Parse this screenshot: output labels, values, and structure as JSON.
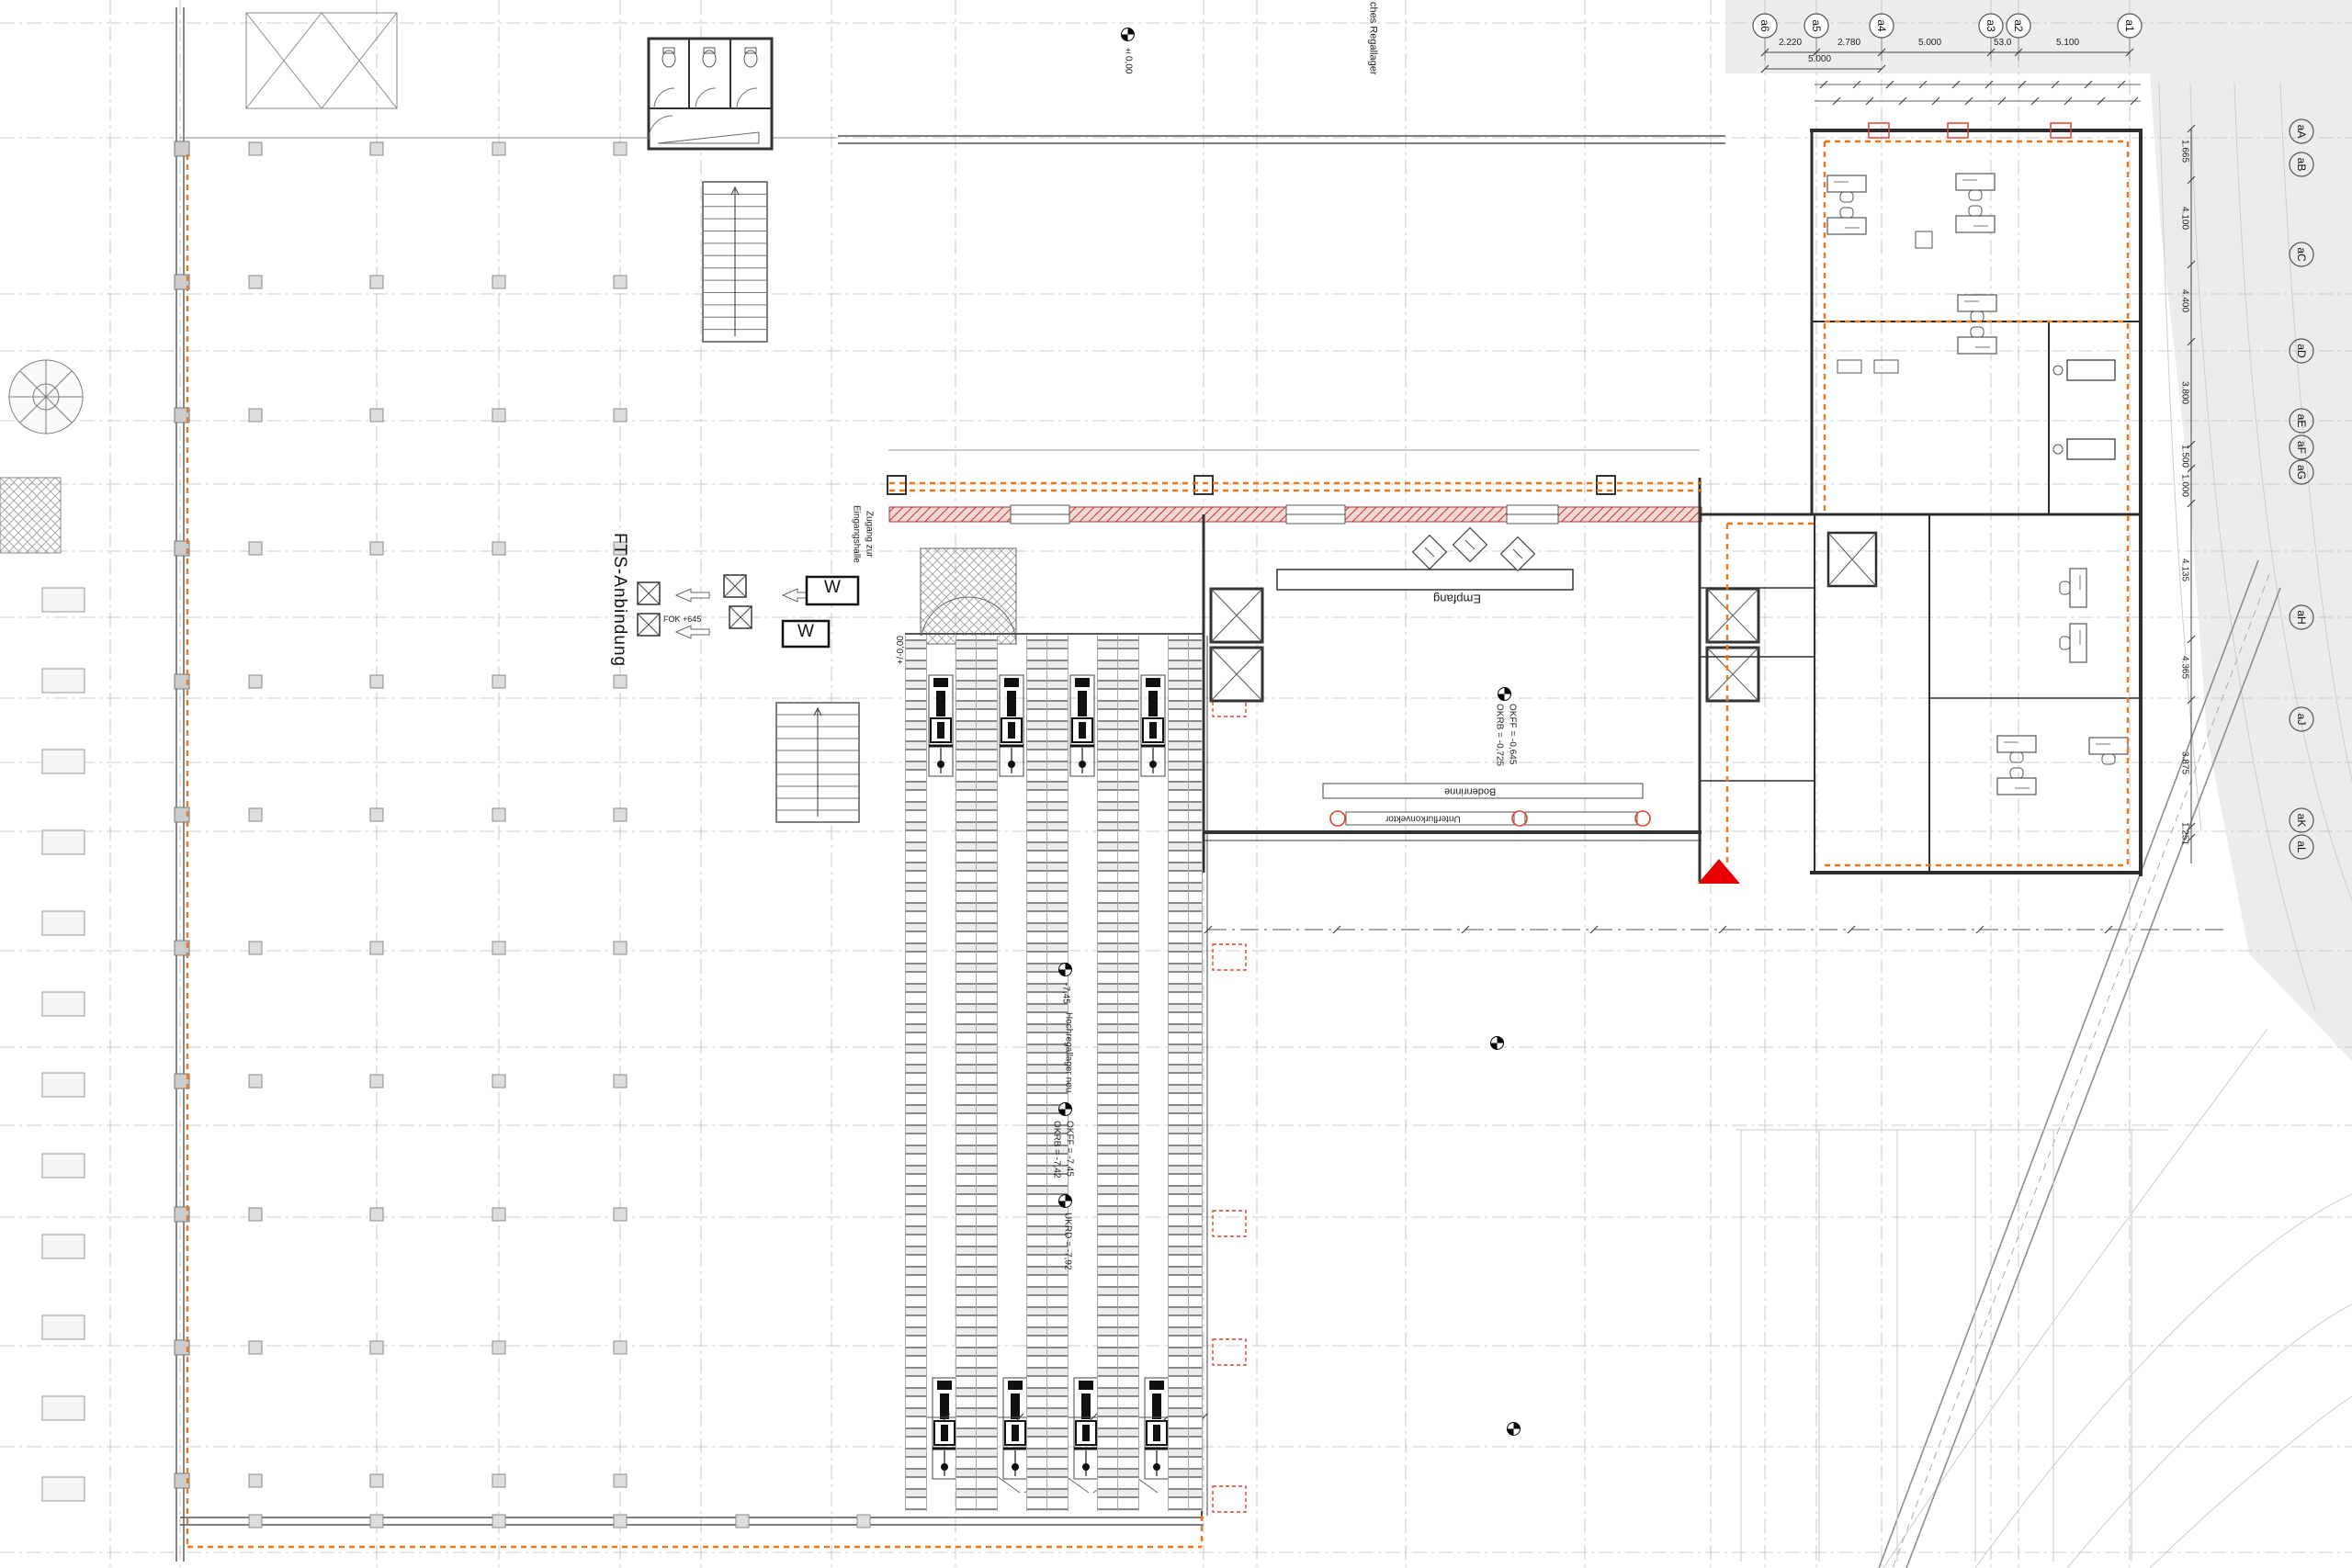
{
  "drawing": {
    "axes": {
      "top": [
        "a6",
        "a5",
        "a4",
        "a3",
        "a2",
        "a1"
      ],
      "right": [
        "aA",
        "aB",
        "aC",
        "aD",
        "aE",
        "aF",
        "aG",
        "aH",
        "aJ",
        "aK",
        "aL"
      ]
    },
    "dims": {
      "top": [
        "2.220",
        "2.780",
        "5.000",
        "53.0",
        "5.100"
      ],
      "top_total": "5.000",
      "right": [
        "1.665",
        "4.100",
        "4.400",
        "3.800",
        "1.500",
        "1.000",
        "4.135",
        "4.365",
        "3.875",
        "1.251"
      ]
    },
    "labels": {
      "regallager": "ches Regallager",
      "fts": "FTS-Anbindung",
      "fok": "FOK +645",
      "zugang1": "Zugang zur",
      "zugang2": "Eingangshalle",
      "empfang": "Empfang",
      "hochregal": "Hochregallager neu",
      "bodenrinne": "Bodenrinne",
      "unterflur": "Unterflurkonvektor",
      "scale_w": "W"
    },
    "levels": {
      "zero": "±0,00",
      "zero2": "+/-0,00",
      "m745": "-7,45",
      "okff745": "OKFF = -7,45",
      "okrb742": "OKRB = -7,42",
      "ukrd792": "UKRD = -7,92",
      "okff0645": "OKFF = -0,645",
      "okrb0725": "OKRB = -0,725"
    },
    "colors": {
      "accent_orange": "#f07818",
      "wall_red": "#c2342a",
      "marker_red": "#e60000",
      "terrain_grey": "#ececec"
    }
  }
}
